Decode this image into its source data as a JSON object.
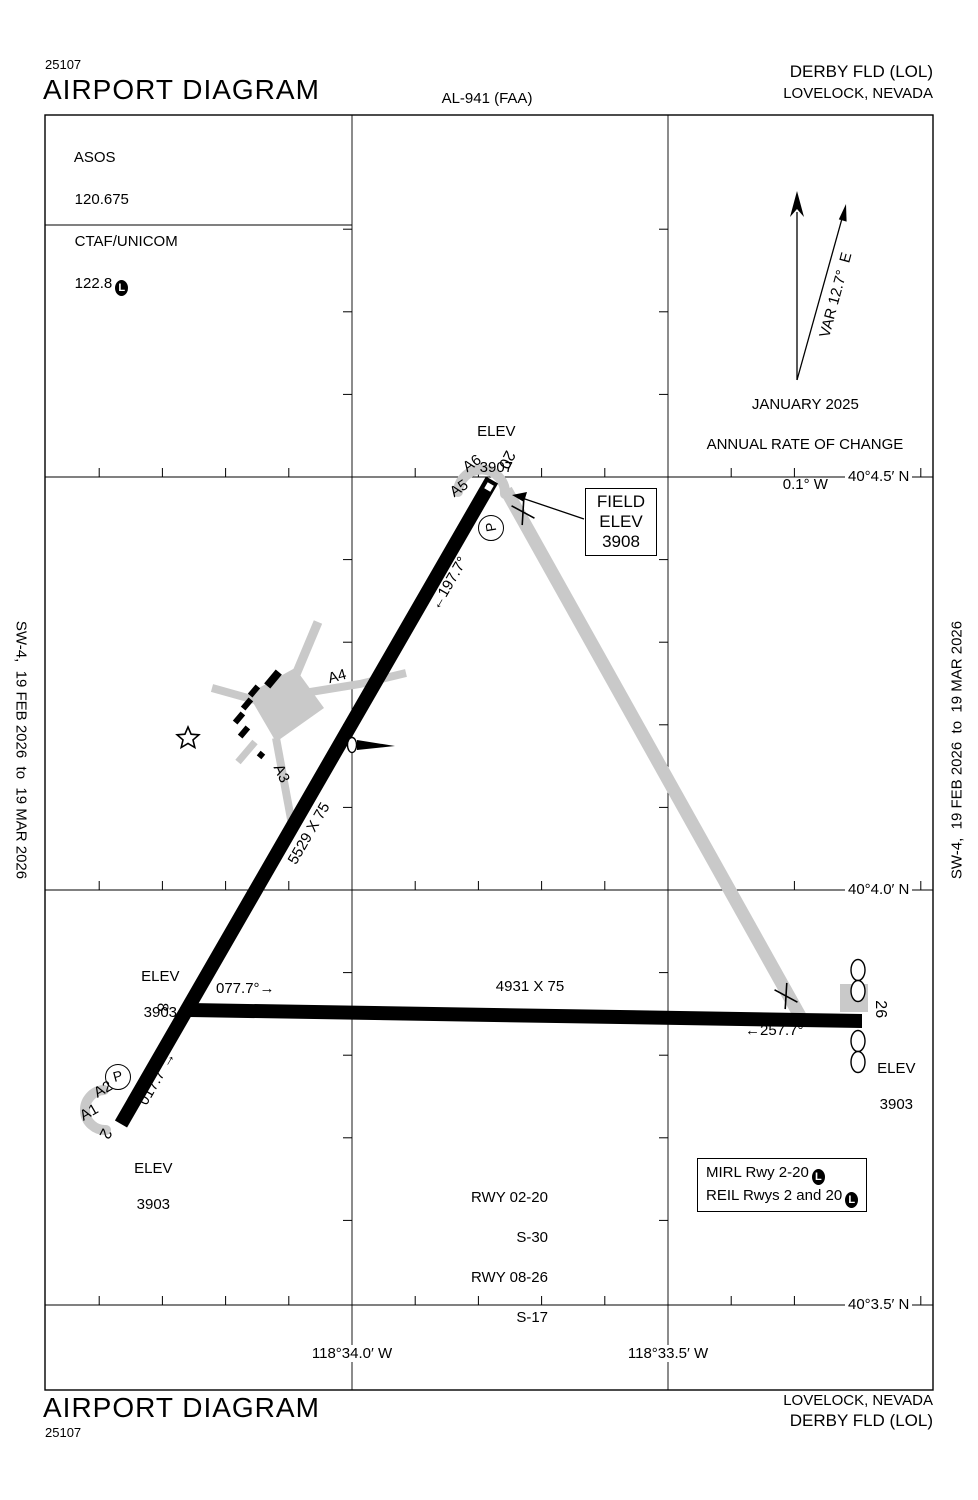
{
  "doc": {
    "chart_number": "25107",
    "title": "AIRPORT DIAGRAM",
    "procedure_id": "AL-941 (FAA)",
    "airport_name": "DERBY FLD (LOL)",
    "city": "LOVELOCK, NEVADA",
    "edition": "SW-4,  19 FEB 2026  to  19 MAR 2026"
  },
  "comm": {
    "line1": "ASOS",
    "line2": "120.675",
    "line3": "CTAF/UNICOM",
    "line4": "122.8",
    "badge": "L"
  },
  "compass": {
    "var_label": "VAR 12.7°  E",
    "date": "JANUARY 2025",
    "rate_line1": "ANNUAL RATE OF CHANGE",
    "rate_line2": "0.1° W"
  },
  "field_elev": {
    "line1": "FIELD",
    "line2": "ELEV",
    "line3": "3908"
  },
  "elevations": {
    "rwy20": {
      "label": "ELEV",
      "value": "3907"
    },
    "rwy08": {
      "label": "ELEV",
      "value": "3903"
    },
    "rwy26": {
      "label": "ELEV",
      "value": "3903"
    },
    "rwy02": {
      "label": "ELEV",
      "value": "3903"
    }
  },
  "runways": {
    "rwy0220": {
      "dimensions": "5529 X 75",
      "hdg_20": "←197.7°",
      "hdg_02": "017.7°→",
      "num_20": "20",
      "num_02": "2"
    },
    "rwy0826": {
      "dimensions": "4931 X 75",
      "hdg_08": "077.7°→",
      "hdg_26": "←257.7°",
      "num_08": "8",
      "num_26": "26"
    }
  },
  "taxiways": {
    "a1": "A1",
    "a2": "A2",
    "a3": "A3",
    "a4": "A4",
    "a5": "A5",
    "a6": "A6",
    "parking": "P"
  },
  "notes": {
    "rwy_data": [
      "RWY 02-20",
      "S-30",
      "RWY 08-26",
      "S-17"
    ]
  },
  "lighting": {
    "line1": "MIRL Rwy 2-20",
    "line2": "REIL Rwys 2 and 20",
    "badge": "L"
  },
  "grid": {
    "lat": [
      "40°4.5′ N",
      "40°4.0′ N",
      "40°3.5′ N"
    ],
    "lon": [
      "118°34.0′ W",
      "118°33.5′ W"
    ]
  },
  "colors": {
    "taxiway_gray": "#c9c9c9",
    "ink": "#000000"
  }
}
